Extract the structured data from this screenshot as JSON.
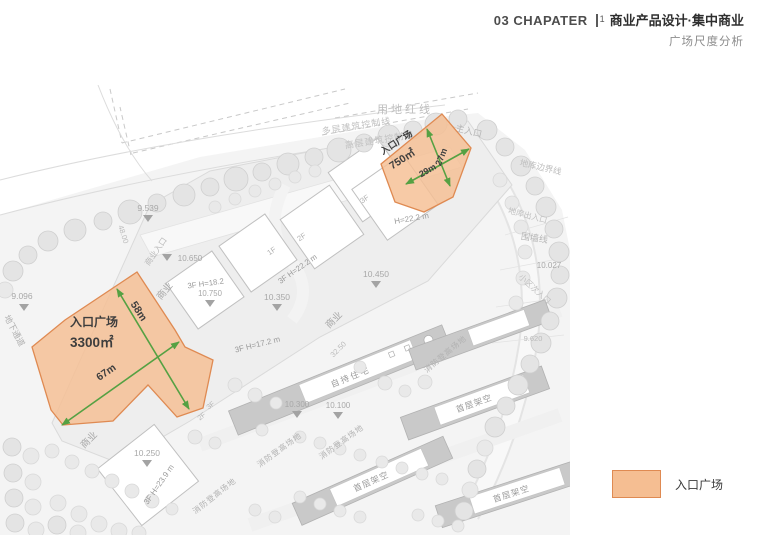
{
  "header": {
    "chapter": "03 CHAPATER",
    "section_num": "1",
    "title": "商业产品设计·集中商业",
    "subtitle": "广场尺度分析"
  },
  "legend": {
    "label": "入口广场"
  },
  "colors": {
    "plaza_fill": "#F5BE92",
    "plaza_border": "#DF8A52",
    "dimension_arrow_green": "#55A143",
    "header_text": "#2f2f2f",
    "map_annotation_gray": "#9a9a9a"
  },
  "plazas": {
    "small": {
      "name": "入口广场",
      "area": "750㎡",
      "dim_a": "27m",
      "dim_b": "29m"
    },
    "large": {
      "name": "入口广场",
      "area": "3300㎡",
      "dim_a": "58m",
      "dim_b": "67m"
    }
  },
  "map_labels": {
    "site_red_line": "用地红线",
    "multi_control": "多层建筑控制线",
    "high_control": "高层建筑控制线",
    "main_entrance": "主入口",
    "garage_boundary": "地库边界线",
    "garage_access": "地库出入口",
    "wall_line": "围墙线",
    "community_entrance": "小区次入口",
    "underpass": "地下通道",
    "commercial_entrance": "商业入口",
    "commercial": "商业",
    "residence": "自持住宅",
    "fire_lane": "消防登高场地",
    "stilt": "首层架空",
    "bldg_18_2": "3F H=18.2",
    "bldg_22_2": "3F H=22.2 m",
    "bldg_22_2_h": "H=22.2 m",
    "bldg_17_2": "3F H=17.2 m",
    "bldg_23_9": "3F H=23.9 m",
    "f1": "1F",
    "f2": "2F",
    "f3": "3F",
    "elev_9539": "9.539",
    "elev_9096": "9.096",
    "elev_10650": "10.650",
    "elev_10750": "10.750",
    "elev_10450": "10.450",
    "elev_10350": "10.350",
    "elev_10300": "10.300",
    "elev_10100": "10.100",
    "elev_10027": "10.027",
    "elev_10250": "10.250",
    "elev_9620": "9.620",
    "dim_4800": "48.00",
    "dim_3250": "32.50"
  }
}
